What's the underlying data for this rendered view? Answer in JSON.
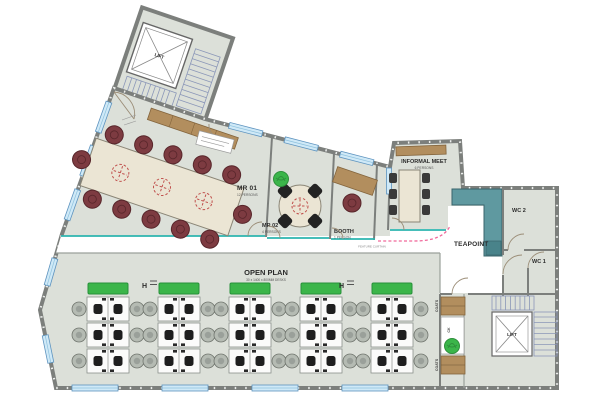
{
  "plan": {
    "rooms": {
      "lift_upper": {
        "label": "LIFT"
      },
      "lift_lower": {
        "label": "LIFT"
      },
      "mr01": {
        "label": "MR 01",
        "capacity": "12 PERSONS"
      },
      "mr02": {
        "label": "MR 02",
        "capacity": "4 PERSONS"
      },
      "booth": {
        "label": "BOOTH",
        "capacity": "1 PERSON"
      },
      "informal_meet": {
        "label": "INFORMAL MEET",
        "capacity": "6 PERSONS"
      },
      "teapoint": {
        "label": "TEAPOINT"
      },
      "wc1": {
        "label": "WC 1"
      },
      "wc2": {
        "label": "WC 2"
      },
      "open_plan": {
        "label": "OPEN PLAN",
        "subtitle": "30 x 1400 x 800MM DESKS"
      },
      "coats_upper": {
        "label": "COATS"
      },
      "coats_lower": {
        "label": "COATS"
      },
      "cloak": {
        "label": "CK"
      }
    },
    "annotations": {
      "feature_curtain": "FEATURE CURTAIN",
      "heater_left": "H",
      "heater_right": "H"
    },
    "colors": {
      "floor": "#dce0d9",
      "wall": "#7c7f7c",
      "corridor": "#ffffff",
      "glazing_teal": "#2cb4af",
      "counter_teal": "#5f99a0",
      "window_blue": "#cfe9f7",
      "chair_maroon": "#7d3b41",
      "table_cream": "#ebe5d4",
      "storage_green": "#3bb54a",
      "curtain_pink": "#f0699b",
      "stair_blue": "#8b97b8",
      "desk_chair_black": "#1e1e1e"
    }
  }
}
